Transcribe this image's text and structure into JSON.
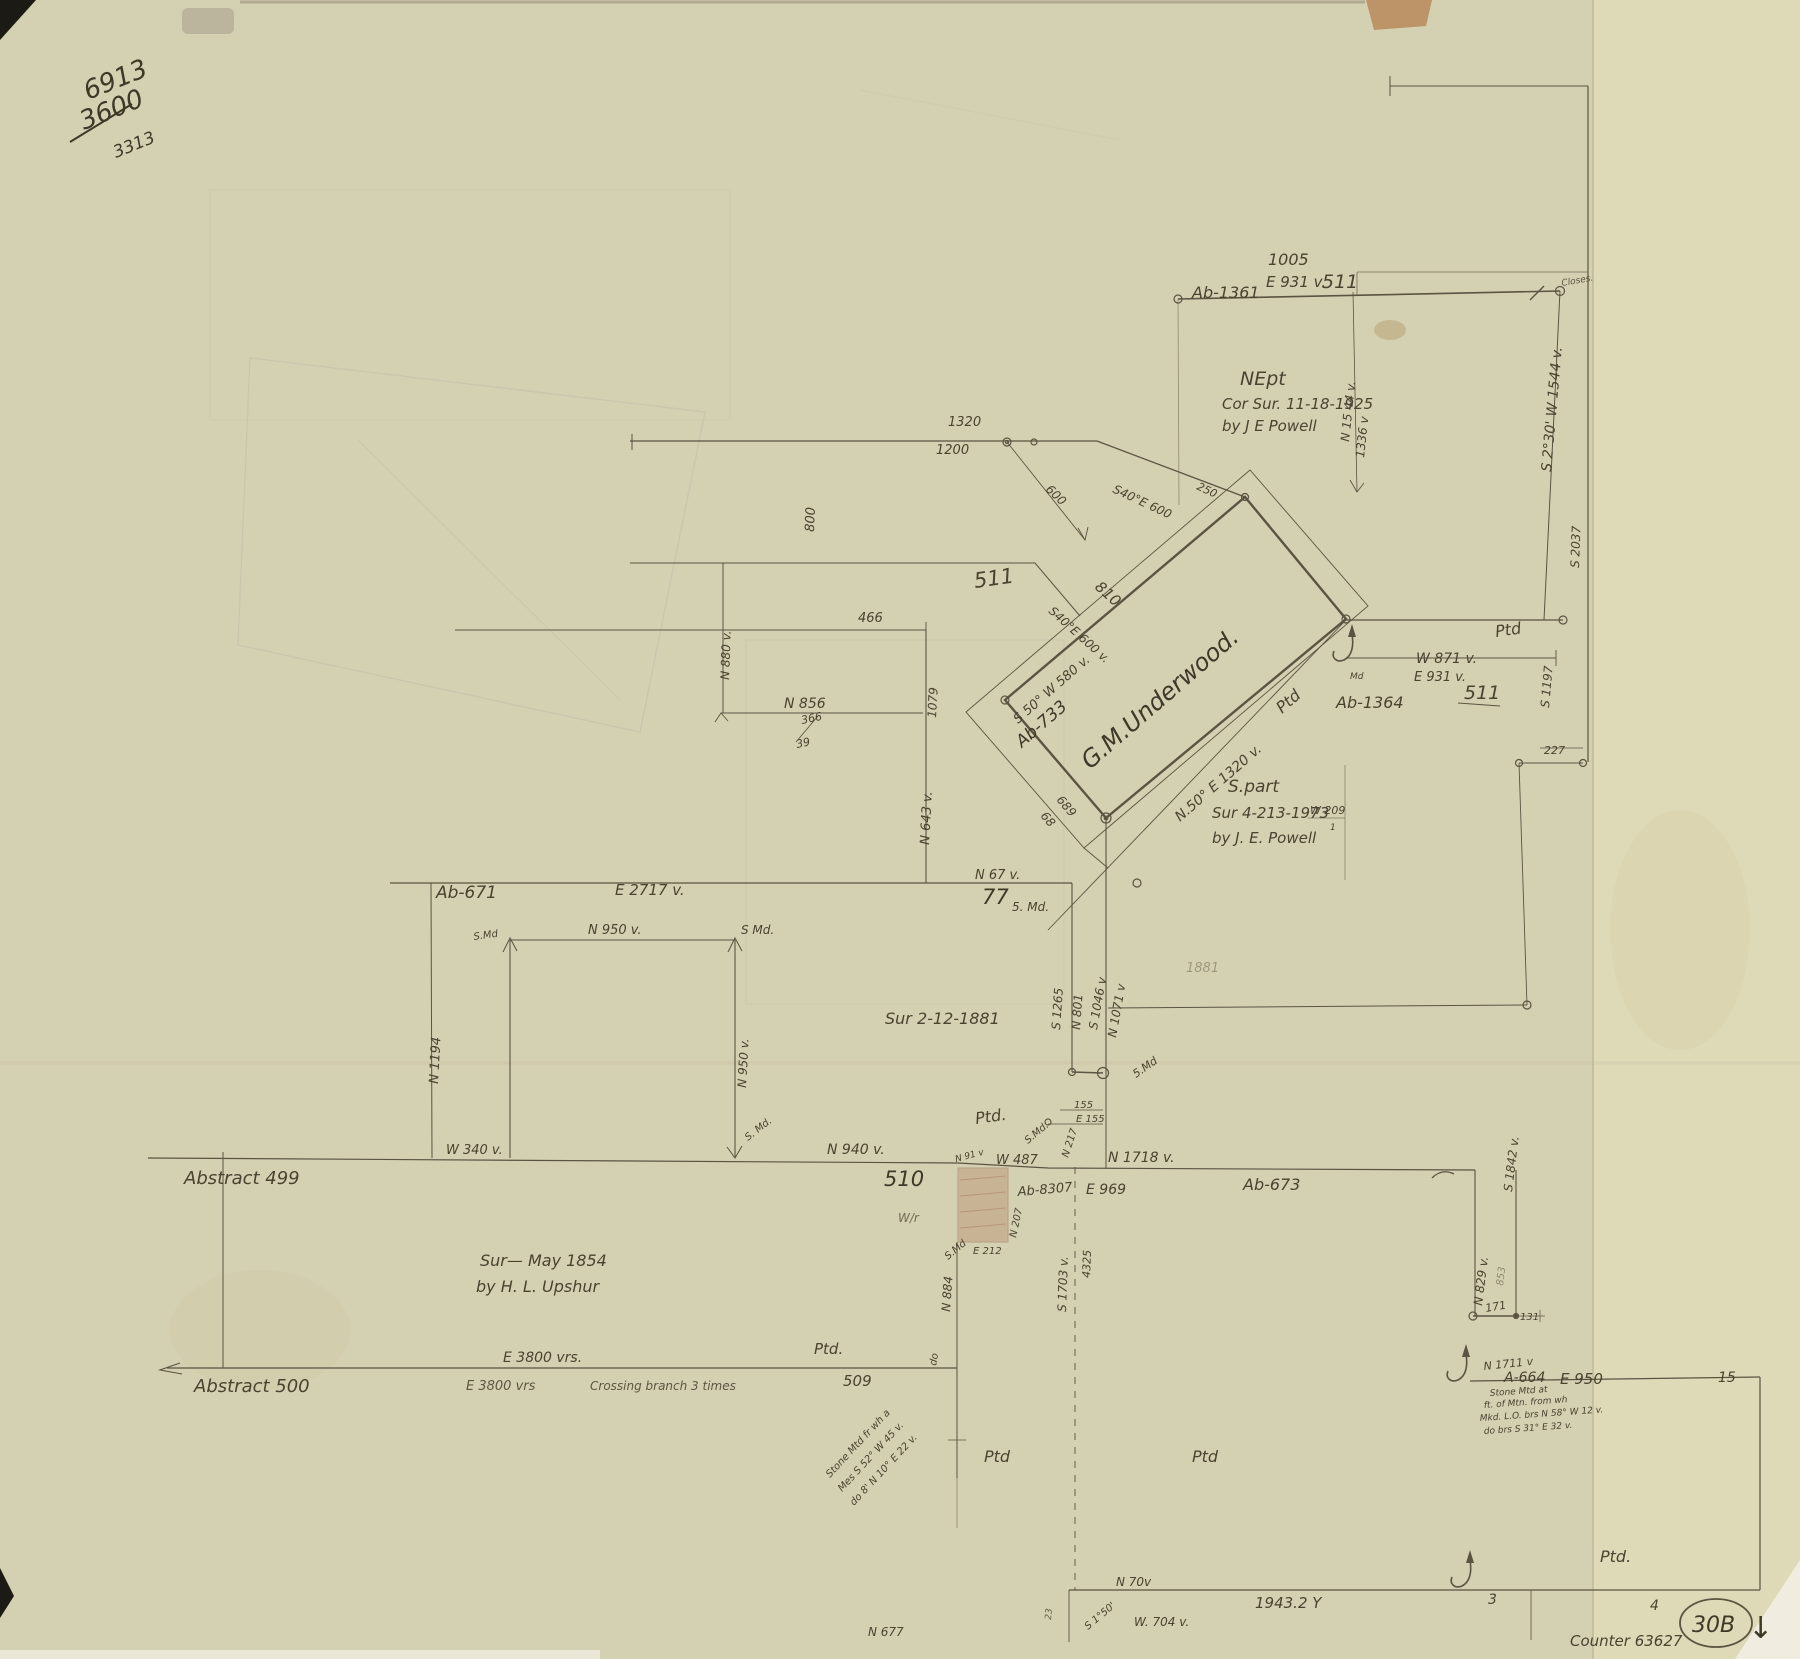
{
  "paper": {
    "base_color": "#d7d2b4",
    "right_strip_color": "#e2dcba",
    "line_color": "#5a5441",
    "hand_color": "#49432f",
    "shaded_parcel_color": "#bd9273"
  },
  "labels": {
    "corner_6913": "6913",
    "corner_3600": "3600",
    "corner_3313": "3313",
    "tr_dist": "1005",
    "tr_bearing": "E 931 v.",
    "tr_abstract": "Ab-1361",
    "tr_section": "511",
    "closes": "Closes.",
    "nept_1": "NEpt",
    "nept_2": "Cor Sur. 11-18-1925",
    "nept_3": "by J E Powell",
    "n1544": "N 15 44 v.",
    "v1336": "1336 v",
    "s230w": "S 2°30' W 1544 v.",
    "s2037": "S 2037",
    "ptd_right": "Ptd",
    "w871": "W 871 v.",
    "e931": "E 931 v.",
    "sec511_mid": "511",
    "ab1364": "Ab-1364",
    "md_small": "Md",
    "d227": "227",
    "s1197": "S 1197",
    "w209": "W 209",
    "w209_tick": "1",
    "d1320": "1320",
    "d1200": "1200",
    "d600": "600",
    "s40e_a": "S40°E 600",
    "s40e_b": "S40°E 600 v.",
    "d810": "810",
    "d250": "250",
    "sec511_top": "511",
    "d466": "466",
    "d800": "800",
    "n880": "N 880 v.",
    "n856": "N 856",
    "f366": "366",
    "f39": "39",
    "d1079": "1079",
    "n643": "N 643 v.",
    "underwood": "G.M.Underwood.",
    "ab733": "Ab-733",
    "s50w": "S 50° W 580 v.",
    "ptd_underwood": "Ptd",
    "n50e": "N.50° E 1320 v.",
    "d689": "689",
    "d68": "68",
    "spart_1": "S.part",
    "spart_2": "Sur 4-213-1973",
    "spart_3": "by J. E. Powell",
    "ab671": "Ab-671",
    "e2717": "E 2717 v.",
    "n67": "N 67 v.",
    "d77": "77",
    "md5": "5. Md.",
    "sur1881": "Sur 2-12-1881",
    "smd_tl": "S.Md",
    "n950_top": "N 950 v.",
    "smd_tr": "S Md.",
    "n1194": "N 1194",
    "n950_right": "N 950 v.",
    "smd_br": "S. Md.",
    "w340": "W 340 v.",
    "s1265": "S 1265",
    "n801": "N 801",
    "s1046": "S 1046 v",
    "n1071": "N 1071 v",
    "n940": "N 940 v.",
    "d510": "510",
    "ptd_center": "Ptd.",
    "d155": "155",
    "e155": "E 155",
    "smd_center": "S.Md.",
    "n217": "N 217",
    "n91": "N 91 v",
    "w487": "W 487",
    "ab8307": "Ab-8307",
    "e969": "E 969",
    "e212": "E 212",
    "n207": "N 207",
    "smd_square": "S.Md",
    "n884": "N 884",
    "do_mark": "do",
    "ghost_1881": "1881",
    "abstract499": "Abstract 499",
    "sur1854_1": "Sur—  May 1854",
    "sur1854_2": "by H. L. Upshur",
    "e3800_top": "E 3800 vrs.",
    "ptd_left": "Ptd.",
    "abstract500": "Abstract 500",
    "e3800_bottom": "E 3800 vrs",
    "crossing": "Crossing branch 3 times",
    "d509": "509",
    "stone_a1": "Stone Mtd fr wh a",
    "stone_a2": "Mes S 52° W 45 v.",
    "stone_a3": "do 8' N 10° E 22 v.",
    "wr": "W/r",
    "s1703": "S 1703 v.",
    "d4325": "4325",
    "n1718": "N 1718 v.",
    "ab673": "Ab-673",
    "smd_right": "5.Md",
    "s1842": "S 1842 v.",
    "n829": "N 829 v.",
    "d853": "853",
    "d171": "171",
    "d131": "131",
    "n1711": "N 1711 v",
    "a664": "A-664",
    "e950": "E 950",
    "d15": "15",
    "stone_b1": "Stone Mtd at",
    "stone_b2": "ft. of Mtn. from wh",
    "stone_b3": "Mkd. L.O. brs N 58° W 12 v.",
    "stone_b4": "do brs S 31° E 32 v.",
    "ptd_b1": "Ptd",
    "ptd_b2": "Ptd",
    "ptd_b3": "Ptd.",
    "n70": "N 70v",
    "d19432": "1943.2 Y",
    "d3": "3",
    "d4": "4",
    "w704": "W. 704 v.",
    "s150": "S 1°50'",
    "n677": "N 677",
    "d23": "23",
    "sheet": "30B",
    "arrow_down": "↓",
    "counter": "Counter 63627"
  }
}
